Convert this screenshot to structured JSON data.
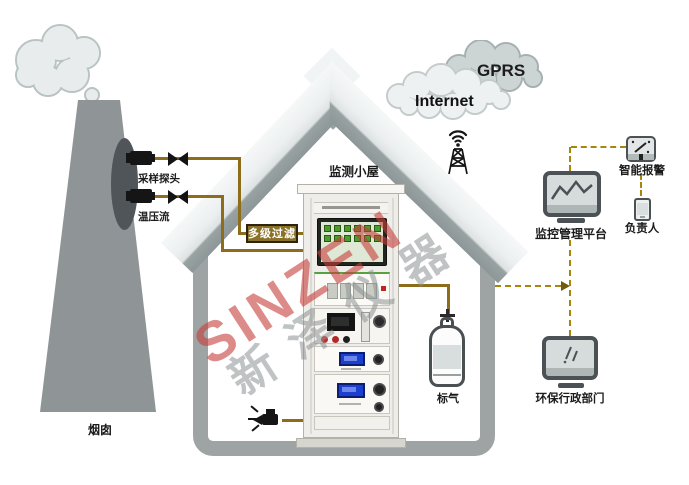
{
  "labels": {
    "stack": "烟囱",
    "sampling_probe": "采样探头",
    "temp_pressure_flow": "温压流",
    "filter": "多级过滤",
    "cabin": "监测小屋",
    "calibration_gas": "标气",
    "platform": "监控管理平台",
    "smart_alarm": "智能报警",
    "person": "负责人",
    "epa": "环保行政部门"
  },
  "clouds": {
    "gprs": "GPRS",
    "internet": "Internet"
  },
  "watermark": {
    "latin": "SINZEN",
    "cjk": "新泽仪器"
  },
  "colors": {
    "pipe_solid": "#8d6d1c",
    "link_dashed": "#a8860d",
    "filter_box": "#8a7228",
    "device_frame": "#4b5154",
    "roof_gray": "#dde2e2",
    "wall_gray": "#9ea4a4",
    "stack_gray": "#8f9496",
    "watermark_red": "#c63e3a",
    "screen_button_green": "#4d9a2e"
  }
}
